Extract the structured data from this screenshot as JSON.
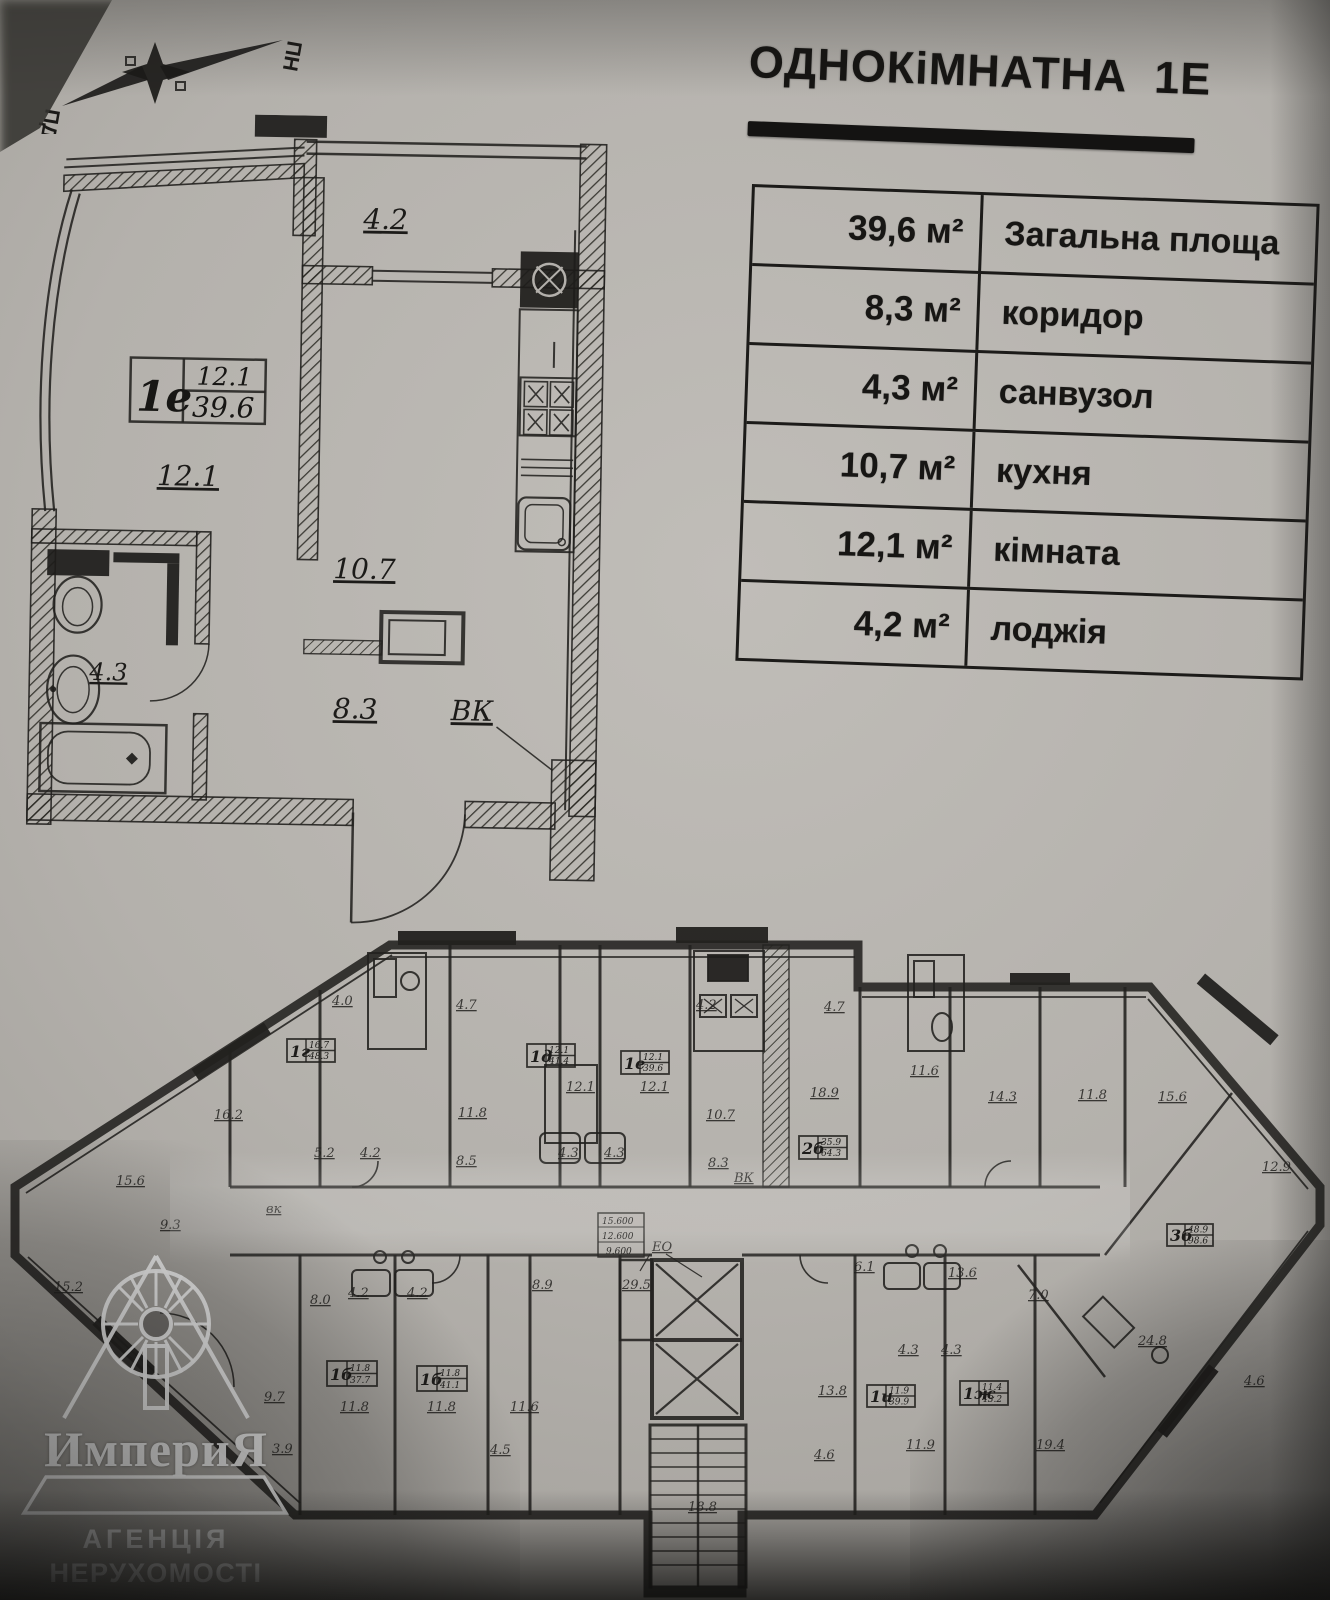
{
  "title": {
    "text": "ОДНОКіМНАТНА  1Е"
  },
  "compass": {
    "north": "ПН",
    "south": "ПД"
  },
  "area_table": {
    "rows": [
      {
        "value": "39,6 м²",
        "label": "Загальна площа"
      },
      {
        "value": "8,3 м²",
        "label": "коридор"
      },
      {
        "value": "4,3 м²",
        "label": "санвузол"
      },
      {
        "value": "10,7 м²",
        "label": "кухня"
      },
      {
        "value": "12,1 м²",
        "label": "кімната"
      },
      {
        "value": "4,2 м²",
        "label": "лоджія"
      }
    ]
  },
  "apartment_plan": {
    "unit_tag": {
      "id": "1е",
      "room_area": "12.1",
      "total_area": "39.6"
    },
    "labels": {
      "loggia": "4.2",
      "room": "12.1",
      "kitchen": "10.7",
      "corridor": "8.3",
      "bathroom": "4.3",
      "vent": "ВК"
    }
  },
  "floor_plan": {
    "unit_tags": [
      {
        "id": "1г",
        "top": "16.7",
        "bottom": "48.3"
      },
      {
        "id": "1д",
        "top": "12.1",
        "bottom": "41.4"
      },
      {
        "id": "1е",
        "top": "12.1",
        "bottom": "39.6"
      },
      {
        "id": "2б",
        "top": "35.9",
        "bottom": "64.3"
      },
      {
        "id": "3б",
        "top": "48.9",
        "bottom": "98.6"
      },
      {
        "id": "1б",
        "top": "11.8",
        "bottom": "37.7"
      },
      {
        "id": "1б",
        "top": "11.8",
        "bottom": "41.1"
      },
      {
        "id": "1и",
        "top": "11.9",
        "bottom": "39.9"
      },
      {
        "id": "1ж",
        "top": "11.4",
        "bottom": "43.2"
      }
    ],
    "elevation_marks": [
      "15.600",
      "12.600",
      "9.600"
    ],
    "eo_label": "ЕО",
    "room_labels": [
      {
        "t": "4.0"
      },
      {
        "t": "4.7"
      },
      {
        "t": "4.2"
      },
      {
        "t": "4.7"
      },
      {
        "t": "16.2"
      },
      {
        "t": "15.6"
      },
      {
        "t": "15.2"
      },
      {
        "t": "9.3"
      },
      {
        "t": "5.2"
      },
      {
        "t": "4.2"
      },
      {
        "t": "11.8"
      },
      {
        "t": "8.5"
      },
      {
        "t": "12.1"
      },
      {
        "t": "12.1"
      },
      {
        "t": "4.3"
      },
      {
        "t": "4.3"
      },
      {
        "t": "10.7"
      },
      {
        "t": "8.3"
      },
      {
        "t": "ВК"
      },
      {
        "t": "18.9"
      },
      {
        "t": "11.6"
      },
      {
        "t": "14.3"
      },
      {
        "t": "11.8"
      },
      {
        "t": "15.6"
      },
      {
        "t": "12.9"
      },
      {
        "t": "13.6"
      },
      {
        "t": "24.8"
      },
      {
        "t": "7.0"
      },
      {
        "t": "4.6"
      },
      {
        "t": "8.9"
      },
      {
        "t": "29.5"
      },
      {
        "t": "8.0"
      },
      {
        "t": "4.2"
      },
      {
        "t": "4.2"
      },
      {
        "t": "9.7"
      },
      {
        "t": "11.8"
      },
      {
        "t": "11.8"
      },
      {
        "t": "11.6"
      },
      {
        "t": "4.5"
      },
      {
        "t": "3.9"
      },
      {
        "t": "13.8"
      },
      {
        "t": "11.9"
      },
      {
        "t": "19.4"
      },
      {
        "t": "18.8"
      },
      {
        "t": "6.1"
      },
      {
        "t": "4.3"
      },
      {
        "t": "4.3"
      },
      {
        "t": "4.6"
      },
      {
        "t": "вк"
      }
    ]
  },
  "logo": {
    "name": "ИмпериЯ",
    "line1": "АГЕНЦІЯ",
    "line2": "НЕРУХОМОСТІ"
  }
}
